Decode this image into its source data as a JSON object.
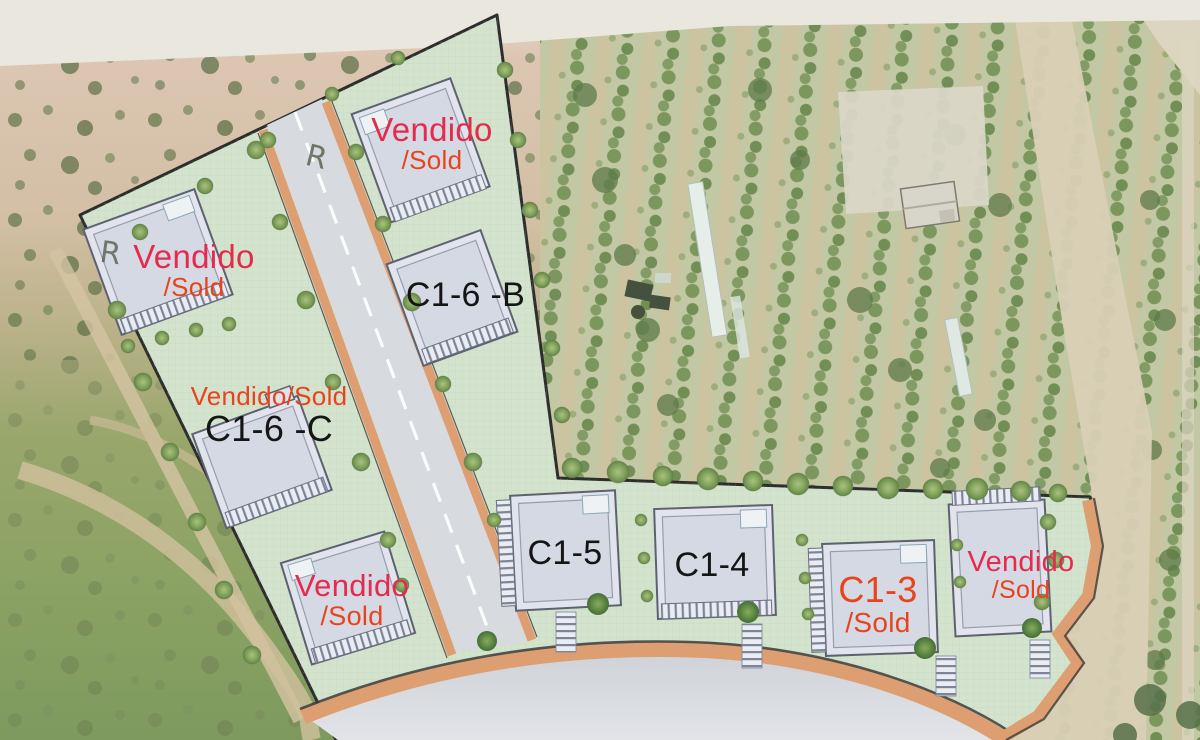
{
  "map": {
    "description": "Aerial photo with overlaid residential development site plan",
    "colors": {
      "sold_pink_red": "#e62a4c",
      "sold_orange_red": "#e8431c",
      "plot_text_black": "#151515",
      "plan_green": "#d3e3ce",
      "sidewalk_orange": "#dd9f72",
      "road_gray": "#d5d8dd",
      "plan_border": "#2d2d2d"
    }
  },
  "plots": [
    {
      "id": "north-villa",
      "lines": [
        {
          "text": "Vendido",
          "color_class": "c-pink"
        },
        {
          "text": "/Sold",
          "color_class": "c-orange"
        }
      ]
    },
    {
      "id": "west-villa",
      "lines": [
        {
          "text": "Vendido",
          "color_class": "c-pink"
        },
        {
          "text": "/Sold",
          "color_class": "c-orange"
        }
      ]
    },
    {
      "id": "villa-c1-6-b",
      "lines": [
        {
          "text": "C1-6 -B",
          "color_class": "c-black"
        }
      ]
    },
    {
      "id": "villa-c1-6-c",
      "lines": [
        {
          "text": "Vendido/Sold",
          "color_class": "c-orange"
        },
        {
          "text": "C1-6 -C",
          "color_class": "c-black"
        }
      ]
    },
    {
      "id": "southwest-villa",
      "lines": [
        {
          "text": "Vendido",
          "color_class": "c-pink"
        },
        {
          "text": "/Sold",
          "color_class": "c-orange"
        }
      ]
    },
    {
      "id": "villa-c1-5",
      "lines": [
        {
          "text": "C1-5",
          "color_class": "c-black"
        }
      ]
    },
    {
      "id": "villa-c1-4",
      "lines": [
        {
          "text": "C1-4",
          "color_class": "c-black"
        }
      ]
    },
    {
      "id": "villa-c1-3",
      "lines": [
        {
          "text": "C1-3",
          "color_class": "c-orange"
        },
        {
          "text": "/Sold",
          "color_class": "c-orange"
        }
      ]
    },
    {
      "id": "east-villa",
      "lines": [
        {
          "text": "Vendido",
          "color_class": "c-pink"
        },
        {
          "text": "/Sold",
          "color_class": "c-orange"
        }
      ]
    }
  ],
  "annotations": {
    "r_marks": [
      "R",
      "R"
    ]
  }
}
